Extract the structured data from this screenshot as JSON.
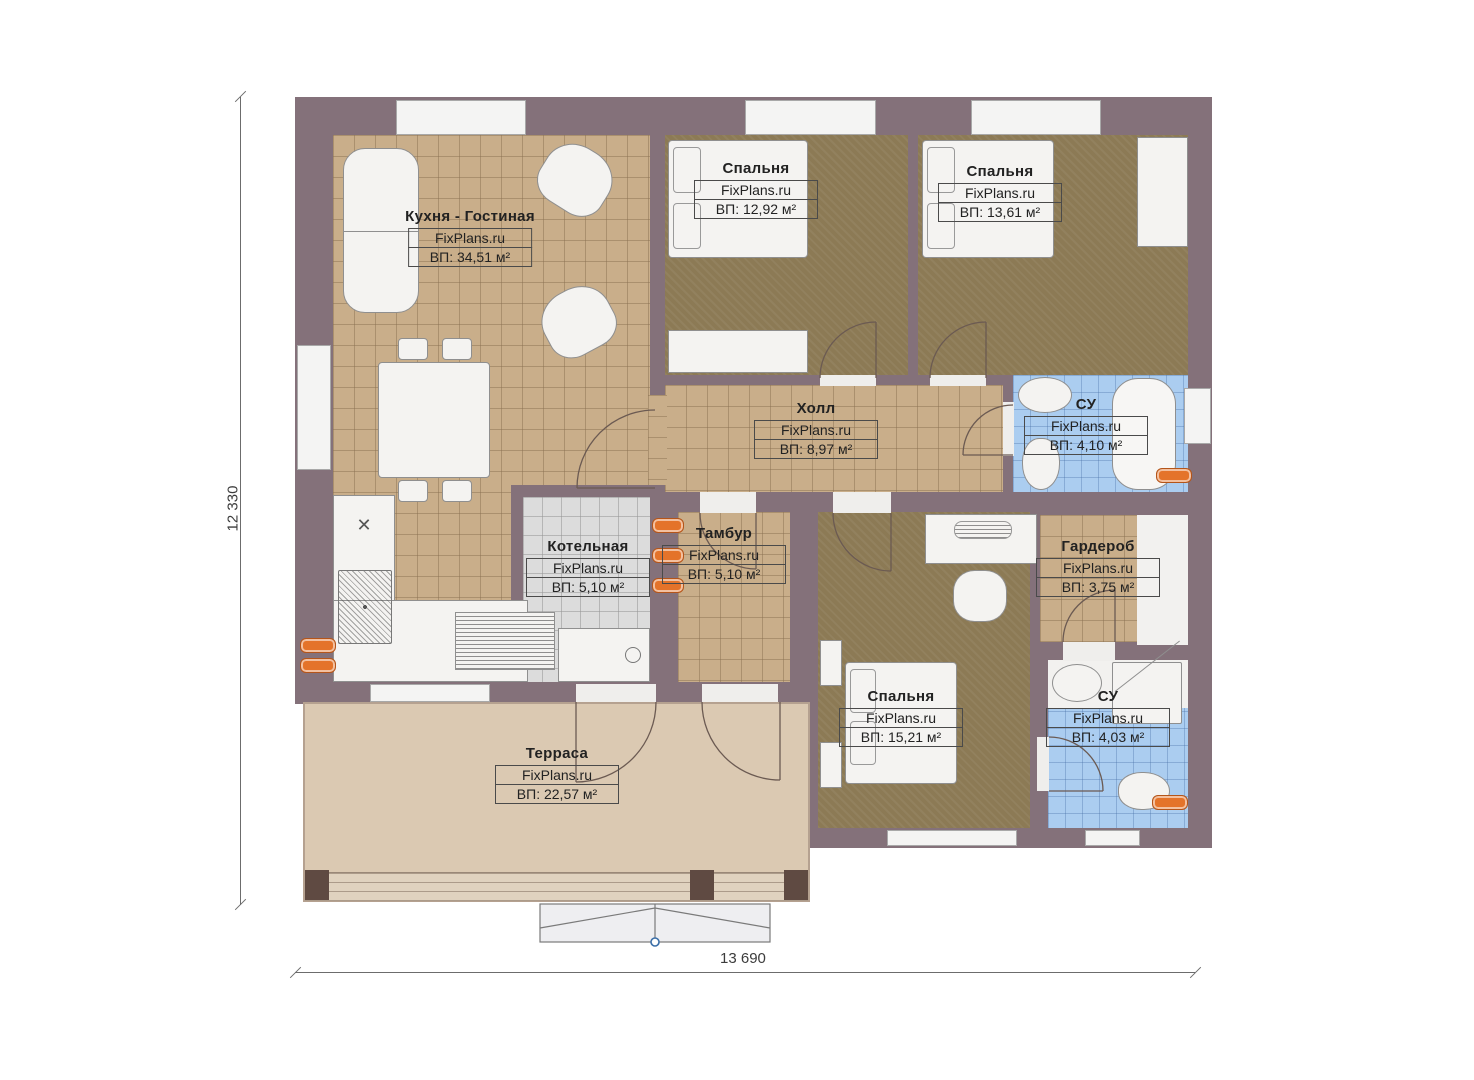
{
  "site": "FixPlans.ru",
  "plan": {
    "dim_height_label": "12 330",
    "dim_width_label": "13 690"
  },
  "rooms": {
    "kitchen": {
      "name": "Кухня - Гостиная",
      "site": "FixPlans.ru",
      "area": "ВП: 34,51 м²"
    },
    "bedroom1": {
      "name": "Спальня",
      "site": "FixPlans.ru",
      "area": "ВП: 12,92 м²"
    },
    "bedroom2": {
      "name": "Спальня",
      "site": "FixPlans.ru",
      "area": "ВП: 13,61 м²"
    },
    "hall": {
      "name": "Холл",
      "site": "FixPlans.ru",
      "area": "ВП: 8,97 м²"
    },
    "bath1": {
      "name": "СУ",
      "site": "FixPlans.ru",
      "area": "ВП: 4,10 м²"
    },
    "boiler": {
      "name": "Котельная",
      "site": "FixPlans.ru",
      "area": "ВП: 5,10 м²"
    },
    "tambour": {
      "name": "Тамбур",
      "site": "FixPlans.ru",
      "area": "ВП: 5,10 м²"
    },
    "wardrobe": {
      "name": "Гардероб",
      "site": "FixPlans.ru",
      "area": "ВП: 3,75 м²"
    },
    "bedroom3": {
      "name": "Спальня",
      "site": "FixPlans.ru",
      "area": "ВП: 15,21 м²"
    },
    "bath2": {
      "name": "СУ",
      "site": "FixPlans.ru",
      "area": "ВП: 4,03 м²"
    },
    "terrace": {
      "name": "Терраса",
      "site": "FixPlans.ru",
      "area": "ВП: 22,57 м²"
    }
  },
  "colors": {
    "wall": "#84717a",
    "floor_tile_tan": "#c9ae8a",
    "floor_carpet": "#8c7a55",
    "floor_bath_blue": "#abcdf0",
    "floor_boiler_gray": "#dcdcdc",
    "floor_terrace": "#dbc9b2",
    "radiator_orange": "#e4732a"
  }
}
